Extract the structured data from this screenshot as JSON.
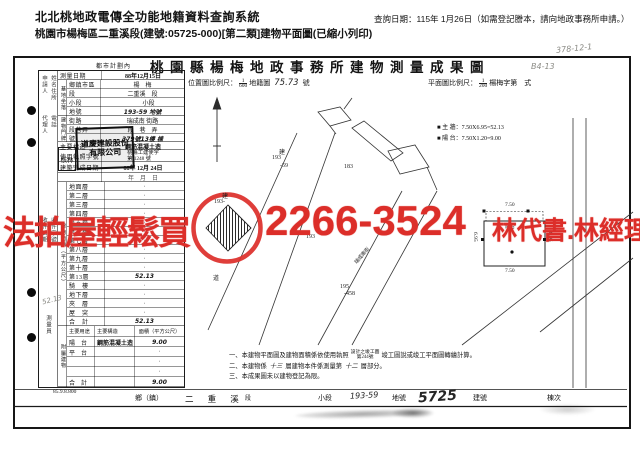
{
  "header": {
    "system_title": "北北桃地政電傳全功能地籍資料查詢系統",
    "query_date": "查詢日期：115年 1月26日（如需登記謄本，請向地政事務所申請。）",
    "doc_line": "桃園市楊梅區二重溪段(建號:05725-000)[第二類]建物平面圖(已縮小列印)"
  },
  "sheet": {
    "zone_note": "都市計劃內",
    "title": "桃園縣楊梅地政事務所建物測量成果圖",
    "page_note": "B4-13",
    "pencil_note": "378-12-1",
    "print_code": "85.9.8.800",
    "loc_scale_label": "位置圖比例尺：",
    "loc_num": "1",
    "loc_den": "600",
    "loc_suffix": "地籍圖",
    "loc_sheet": "75.73",
    "loc_unit": "號",
    "plan_scale_label": "平面圖比例尺：",
    "plan_num": "1",
    "plan_den": "200",
    "plan_suffix": "楊梅字第　式"
  },
  "form": {
    "survey_label": "測量日期",
    "survey_value": "88年12月15日",
    "site_group": "基地坐落",
    "site_rows": [
      {
        "label": "鄉鎮市區",
        "value": "楊　梅"
      },
      {
        "label": "段",
        "value": "二重溪　段"
      },
      {
        "label": "小段",
        "value": "　　小段"
      },
      {
        "label": "地號",
        "value": "193-59 地號"
      }
    ],
    "door_group": "建物門牌",
    "door_rows": [
      {
        "label": "街路",
        "value": "瑞成南 街路"
      },
      {
        "label": "段巷弄",
        "value": "段　巷　弄"
      },
      {
        "label": "號",
        "value": "379號13樓 棟"
      }
    ],
    "structure_label": "主要構造",
    "structure_value": "鋼筋混凝土造",
    "license_label": "使用執照字號",
    "license_line1": "桃縣工建使字",
    "license_line2": "第 1248 號",
    "complete_label": "建築完成日期",
    "complete_value": "88年 12月 24日",
    "complete_blank": "年　月　日",
    "area_group": "建物面積（平方公尺）",
    "area_rows": [
      {
        "label": "地面層",
        "value": "·"
      },
      {
        "label": "第二層",
        "value": "·"
      },
      {
        "label": "第三層",
        "value": "·"
      },
      {
        "label": "第四層",
        "value": "·"
      },
      {
        "label": "第五層",
        "value": "·"
      },
      {
        "label": "第六層",
        "value": "·"
      },
      {
        "label": "第七層",
        "value": "·"
      },
      {
        "label": "第八層",
        "value": "·"
      },
      {
        "label": "第九層",
        "value": "·"
      },
      {
        "label": "第十層",
        "value": "·"
      },
      {
        "label": "第13層",
        "value": "52.13"
      },
      {
        "label": "騎　樓",
        "value": "·"
      },
      {
        "label": "地下層",
        "value": "·"
      },
      {
        "label": "夾　層",
        "value": "·"
      },
      {
        "label": "屋　突",
        "value": "·"
      },
      {
        "label": "合　計",
        "value": "52.13"
      }
    ],
    "attached_group": "附屬建物",
    "attached_header": {
      "use": "主要用途",
      "structure": "主要構造",
      "area": "面積（平方公尺）"
    },
    "attached_rows": [
      {
        "use": "陽　台",
        "structure": "鋼筋混凝土造",
        "area": "9.00"
      },
      {
        "use": "平　台",
        "structure": "",
        "area": "·"
      },
      {
        "use": "",
        "structure": "",
        "area": "·"
      },
      {
        "use": "",
        "structure": "",
        "area": "·"
      },
      {
        "use": "合　計",
        "structure": "",
        "area": "9.00"
      }
    ],
    "owner_seal": "道慶建設股份有限公司",
    "check_seal": "核林",
    "margin": {
      "applicant": "申請人",
      "name_addr": "姓名住所",
      "agent": "代理人",
      "phone": "電話",
      "recv_date": "收件日期",
      "recv_no": "收件字號",
      "surveyor": "測量員",
      "pencil": "52.13"
    }
  },
  "legend": {
    "square": "■",
    "wall": "主 牆：7.50X6.95=52.13",
    "balcony": "陽 台：7.50X1.20=9.00"
  },
  "plan": {
    "dim_top": "7.50",
    "dim_bottom": "7.50",
    "dim_left": "6.95",
    "dim_right": "6.95",
    "room": "陽台"
  },
  "map": {
    "labels": [
      {
        "text": "建"
      },
      {
        "text": "193"
      },
      {
        "text": "-59"
      },
      {
        "text": "183"
      },
      {
        "text": "建"
      },
      {
        "text": "193-"
      },
      {
        "text": "193"
      },
      {
        "text": "道"
      },
      {
        "text": "195"
      },
      {
        "text": "-458"
      },
      {
        "text": "瑞成南街"
      }
    ]
  },
  "notes": {
    "n1a": "一、本建物平面圖及建物面積係依使用執照",
    "n1s1": "設計之竣工圖",
    "n1s2": "第244號",
    "n1b": "竣工圖說或竣工平面圖轉繪計算。",
    "n2a": "二、本建物係",
    "n2h1": "十三",
    "n2b": "層建物本件係測量第",
    "n2h2": "十二",
    "n2c": "層部分。",
    "n3": "三、本成果圖未以建物登記為限。"
  },
  "strip": {
    "township": "鄉（鎮）",
    "section_name": "二 重 溪",
    "section_label": "段",
    "subsection_label": "小段",
    "parcel_no": "193-59",
    "parcel_label": "地號",
    "building_no": "5725",
    "building_label": "建號",
    "unit_label": "棟次"
  },
  "watermark": {
    "text_left": "法拍屋輕鬆買",
    "phone": "2266-3524",
    "text_right": "林代書.林經理",
    "color": "#dc2e29"
  }
}
